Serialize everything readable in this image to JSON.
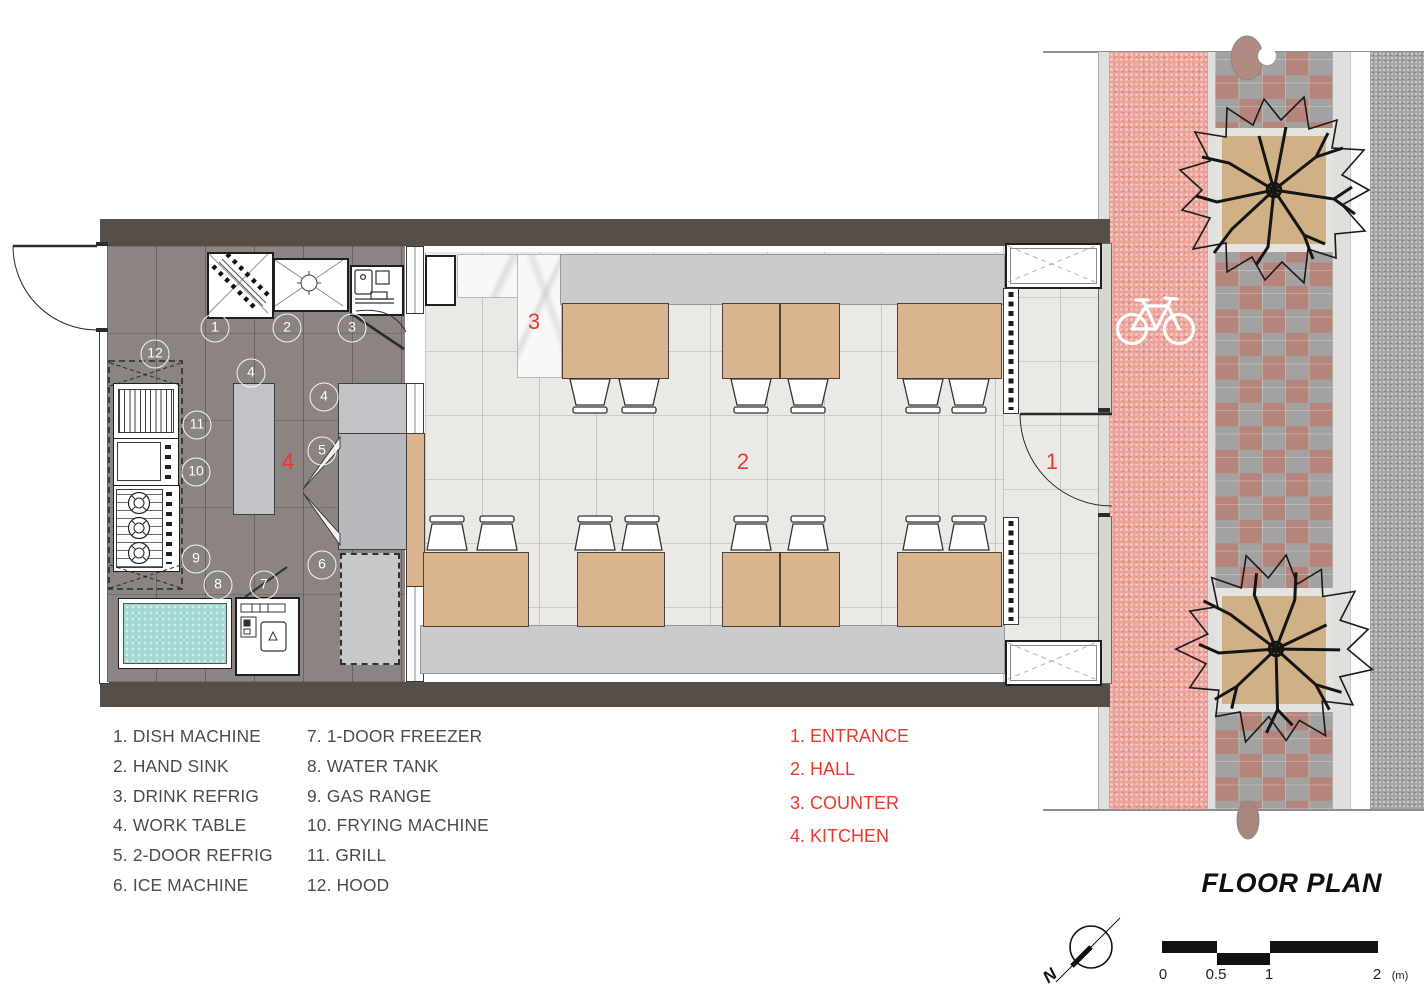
{
  "title": "FLOOR PLAN",
  "north_label": "N",
  "scale": {
    "labels": [
      "0",
      "0.5",
      "1",
      "2",
      "(m)"
    ]
  },
  "legend_equipment": {
    "items": [
      "1. DISH MACHINE",
      "2. HAND SINK",
      "3. DRINK REFRIG",
      "4. WORK TABLE",
      "5. 2-DOOR REFRIG",
      "6. ICE MACHINE",
      "7. 1-DOOR FREEZER",
      "8. WATER TANK",
      "9. GAS RANGE",
      "10. FRYING MACHINE",
      "11. GRILL",
      "12. HOOD"
    ]
  },
  "legend_zones": {
    "items": [
      "1. ENTRANCE",
      "2. HALL",
      "3. COUNTER",
      "4. KITCHEN"
    ]
  },
  "plan": {
    "zone_numbers": [
      "1",
      "2",
      "3",
      "4"
    ],
    "markers": [
      "1",
      "2",
      "3",
      "12",
      "4",
      "4",
      "5",
      "11",
      "10",
      "9",
      "6",
      "8",
      "7"
    ]
  },
  "colors": {
    "accent_red": "#E8392B",
    "wall": "#564F49",
    "table_wood": "#D9B48E",
    "bike_lane_pink": "#ECA39A",
    "water_teal": "#A3D9D4"
  }
}
